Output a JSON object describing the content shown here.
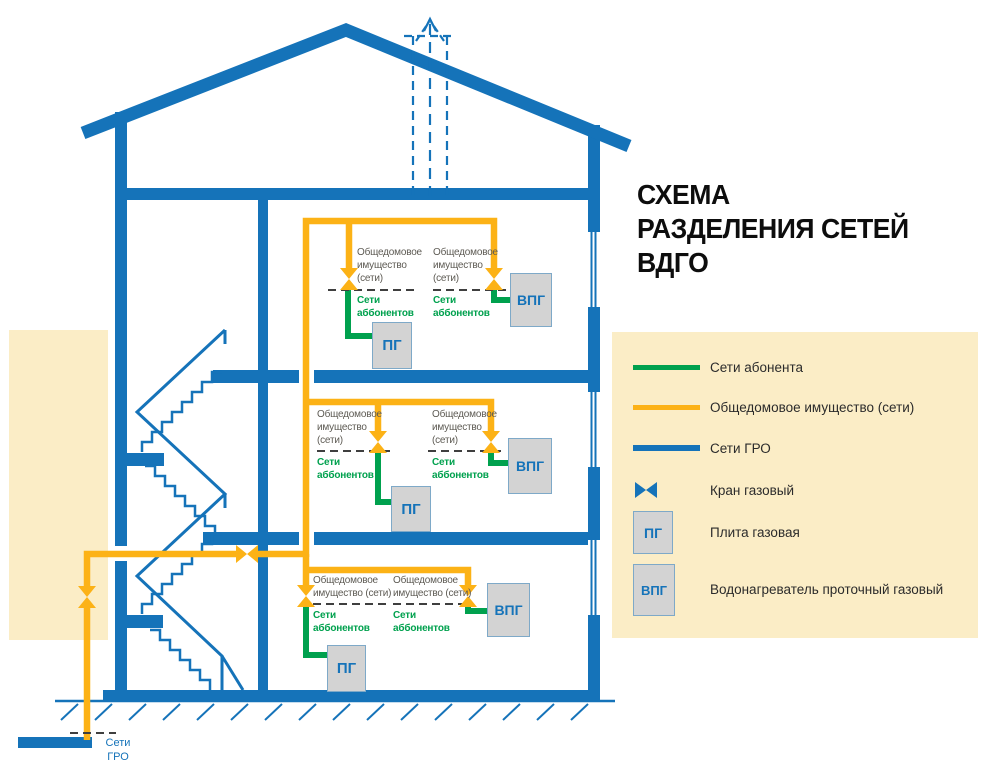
{
  "title": {
    "lines": [
      "СХЕМА",
      "РАЗДЕЛЕНИЯ СЕТЕЙ",
      "ВДГО"
    ]
  },
  "colors": {
    "blue": "#1573b9",
    "yellow": "#fcb216",
    "green": "#00a14e",
    "beige": "#fbedc6",
    "box_fill": "#d3d3d3",
    "box_border": "#7ea9c8",
    "label_gray": "#5d5a53",
    "text_dark": "#2b2b2b",
    "dash": "#3f3f3f",
    "title": "#0d0d0d"
  },
  "floor_labels": {
    "common_line1": "Общедомовое",
    "common_line2": "имущество",
    "common_line3": "(сети)",
    "common_line2_inline": "имущество (сети)",
    "subscriber_line1": "Сети",
    "subscriber_line2": "аббонентов"
  },
  "appliances": {
    "stove_label": "ПГ",
    "heater_label": "ВПГ"
  },
  "legend": {
    "items": [
      {
        "icon": "green-line",
        "label": "Сети абонента"
      },
      {
        "icon": "yellow-line",
        "label": "Общедомовое имущество (сети)"
      },
      {
        "icon": "blue-line",
        "label": "Сети ГРО"
      },
      {
        "icon": "gas-valve",
        "label": "Кран газовый"
      },
      {
        "icon": "box",
        "symbol": "ПГ",
        "label": "Плита газовая"
      },
      {
        "icon": "box",
        "symbol": "ВПГ",
        "label": "Водонагреватель проточный газовый"
      }
    ]
  },
  "gro_source": {
    "line1": "Сети",
    "line2": "ГРО"
  }
}
